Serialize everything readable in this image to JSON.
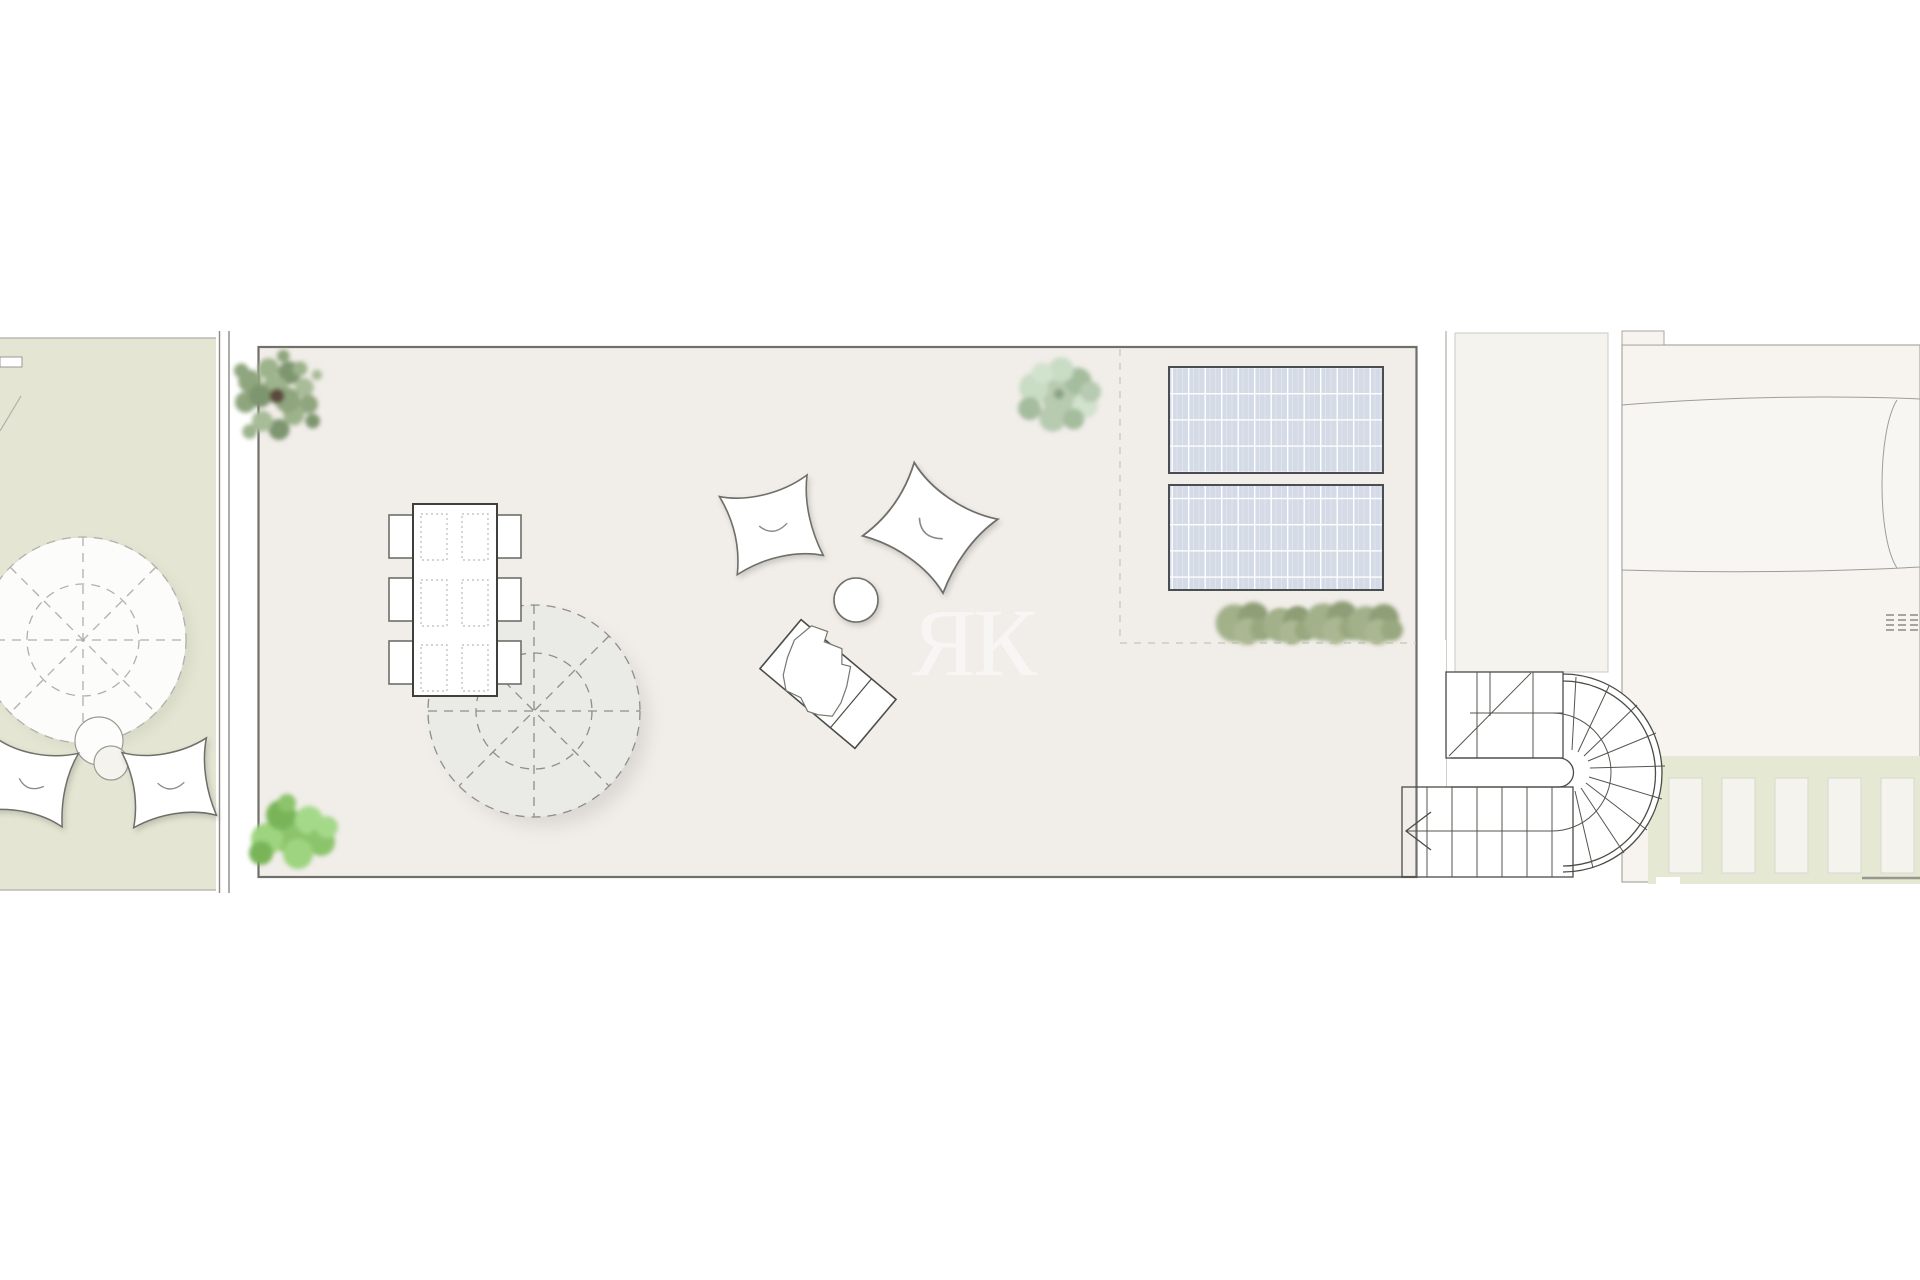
{
  "watermark": {
    "text": "ЯК",
    "color": "#ffffff",
    "opacity": "0.55"
  },
  "colors": {
    "background": "#ffffff",
    "left_garden_fill": "#e4e6d3",
    "terrace_fill": "#f1ede9",
    "terrace_border": "#716f6a",
    "corridor_fill": "#f5f3ee",
    "building_fill": "#f7f4f0",
    "vault_fill": "#f8f6f2",
    "green_strip_fill": "#e5e8d2",
    "solar_panel_fill": "#d4dae6",
    "solar_panel_border": "#4a4d52",
    "parasol_left_fill": "#fcfcfa",
    "parasol_main_fill": "#eaeae6",
    "furniture_fill": "#ffffff",
    "stair_line": "#4b4b47",
    "plant_dark": "#8fa57e",
    "plant_bright": "#8cc46c",
    "plant_sage": "#b7cbb1",
    "plant_grass": "#a0ae87"
  },
  "legend": {
    "left_garden": "side garden with parasol, stools and bean bags",
    "main_terrace": "roof terrace",
    "dining_chairs_count": 6,
    "solar_panels_count": 2,
    "shrub_row_count": 4,
    "deck_planks_count": 5,
    "staircase": "U-shaped winder stair with curved end",
    "watermark_meaning": "RK monogram"
  }
}
